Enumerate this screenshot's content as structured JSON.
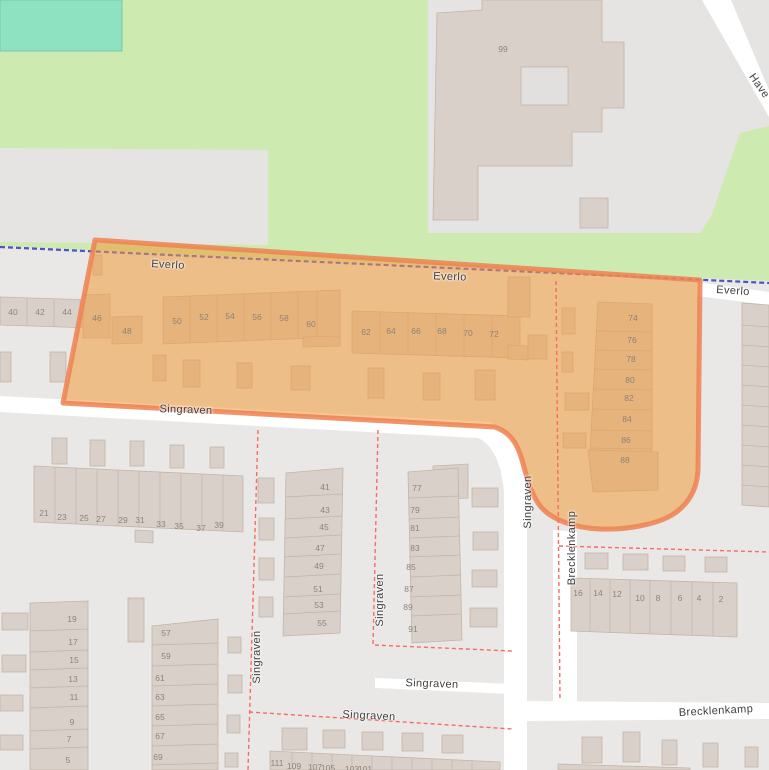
{
  "colors": {
    "grass": "#cdeab0",
    "pitch": "#8fe2c1",
    "residential": "#e9e8e6",
    "building": "#d9d0c9",
    "building_outline": "#c3b5a8",
    "road": "#ffffff",
    "highlight_fill": "#f29a3c",
    "highlight_stroke": "#ee8152",
    "admin_boundary_blue": "#4f51c6",
    "boundary_red": "#f96b60",
    "street_label": "#3f3f3f",
    "housenumber": "#8a8075"
  },
  "streets": [
    {
      "name": "Everlo",
      "x": 168,
      "y": 265,
      "rot": 3
    },
    {
      "name": "Everlo",
      "x": 450,
      "y": 277,
      "rot": 2
    },
    {
      "name": "Everlo",
      "x": 733,
      "y": 291,
      "rot": 4
    },
    {
      "name": "Have",
      "x": 759,
      "y": 86,
      "rot": 55
    },
    {
      "name": "Singraven",
      "x": 186,
      "y": 410,
      "rot": 2
    },
    {
      "name": "Singraven",
      "x": 528,
      "y": 502,
      "rot": -90
    },
    {
      "name": "Brecklenkamp",
      "x": 572,
      "y": 548,
      "rot": -90
    },
    {
      "name": "Singraven",
      "x": 257,
      "y": 657,
      "rot": -90
    },
    {
      "name": "Singraven",
      "x": 380,
      "y": 600,
      "rot": -90
    },
    {
      "name": "Singraven",
      "x": 432,
      "y": 684,
      "rot": 2
    },
    {
      "name": "Singraven",
      "x": 369,
      "y": 716,
      "rot": 3
    },
    {
      "name": "Brecklenkamp",
      "x": 716,
      "y": 711,
      "rot": -3
    }
  ],
  "house_numbers": [
    {
      "n": "40",
      "x": 13,
      "y": 312
    },
    {
      "n": "42",
      "x": 40,
      "y": 312
    },
    {
      "n": "44",
      "x": 67,
      "y": 312
    },
    {
      "n": "46",
      "x": 97,
      "y": 318
    },
    {
      "n": "48",
      "x": 127,
      "y": 331
    },
    {
      "n": "50",
      "x": 177,
      "y": 321
    },
    {
      "n": "52",
      "x": 204,
      "y": 317
    },
    {
      "n": "54",
      "x": 230,
      "y": 316
    },
    {
      "n": "56",
      "x": 257,
      "y": 317
    },
    {
      "n": "58",
      "x": 284,
      "y": 318
    },
    {
      "n": "60",
      "x": 311,
      "y": 324
    },
    {
      "n": "62",
      "x": 366,
      "y": 332
    },
    {
      "n": "64",
      "x": 391,
      "y": 331
    },
    {
      "n": "66",
      "x": 416,
      "y": 331
    },
    {
      "n": "68",
      "x": 442,
      "y": 331
    },
    {
      "n": "70",
      "x": 468,
      "y": 333
    },
    {
      "n": "72",
      "x": 494,
      "y": 334
    },
    {
      "n": "74",
      "x": 633,
      "y": 318
    },
    {
      "n": "76",
      "x": 632,
      "y": 340
    },
    {
      "n": "78",
      "x": 631,
      "y": 359
    },
    {
      "n": "80",
      "x": 630,
      "y": 380
    },
    {
      "n": "82",
      "x": 629,
      "y": 398
    },
    {
      "n": "84",
      "x": 627,
      "y": 419
    },
    {
      "n": "86",
      "x": 626,
      "y": 440
    },
    {
      "n": "88",
      "x": 625,
      "y": 460
    },
    {
      "n": "99",
      "x": 503,
      "y": 49
    },
    {
      "n": "21",
      "x": 44,
      "y": 513
    },
    {
      "n": "23",
      "x": 62,
      "y": 517
    },
    {
      "n": "25",
      "x": 84,
      "y": 518
    },
    {
      "n": "27",
      "x": 101,
      "y": 519
    },
    {
      "n": "29",
      "x": 123,
      "y": 520
    },
    {
      "n": "31",
      "x": 140,
      "y": 520
    },
    {
      "n": "33",
      "x": 161,
      "y": 524
    },
    {
      "n": "35",
      "x": 179,
      "y": 526
    },
    {
      "n": "37",
      "x": 201,
      "y": 528
    },
    {
      "n": "39",
      "x": 219,
      "y": 525
    },
    {
      "n": "19",
      "x": 72,
      "y": 619
    },
    {
      "n": "17",
      "x": 73,
      "y": 642
    },
    {
      "n": "15",
      "x": 74,
      "y": 660
    },
    {
      "n": "13",
      "x": 73,
      "y": 679
    },
    {
      "n": "11",
      "x": 74,
      "y": 697
    },
    {
      "n": "9",
      "x": 72,
      "y": 722
    },
    {
      "n": "7",
      "x": 69,
      "y": 739
    },
    {
      "n": "5",
      "x": 68,
      "y": 760
    },
    {
      "n": "57",
      "x": 166,
      "y": 633
    },
    {
      "n": "59",
      "x": 166,
      "y": 656
    },
    {
      "n": "61",
      "x": 160,
      "y": 678
    },
    {
      "n": "63",
      "x": 160,
      "y": 697
    },
    {
      "n": "65",
      "x": 160,
      "y": 717
    },
    {
      "n": "67",
      "x": 160,
      "y": 736
    },
    {
      "n": "69",
      "x": 158,
      "y": 757
    },
    {
      "n": "41",
      "x": 325,
      "y": 487
    },
    {
      "n": "43",
      "x": 325,
      "y": 510
    },
    {
      "n": "45",
      "x": 324,
      "y": 527
    },
    {
      "n": "47",
      "x": 320,
      "y": 548
    },
    {
      "n": "49",
      "x": 319,
      "y": 566
    },
    {
      "n": "51",
      "x": 318,
      "y": 589
    },
    {
      "n": "53",
      "x": 319,
      "y": 605
    },
    {
      "n": "55",
      "x": 322,
      "y": 623
    },
    {
      "n": "77",
      "x": 417,
      "y": 488
    },
    {
      "n": "79",
      "x": 415,
      "y": 510
    },
    {
      "n": "81",
      "x": 415,
      "y": 528
    },
    {
      "n": "83",
      "x": 415,
      "y": 548
    },
    {
      "n": "85",
      "x": 411,
      "y": 567
    },
    {
      "n": "87",
      "x": 409,
      "y": 589
    },
    {
      "n": "89",
      "x": 408,
      "y": 607
    },
    {
      "n": "91",
      "x": 413,
      "y": 629
    },
    {
      "n": "16",
      "x": 578,
      "y": 593
    },
    {
      "n": "14",
      "x": 598,
      "y": 593
    },
    {
      "n": "12",
      "x": 617,
      "y": 594
    },
    {
      "n": "10",
      "x": 640,
      "y": 598
    },
    {
      "n": "8",
      "x": 658,
      "y": 598
    },
    {
      "n": "6",
      "x": 680,
      "y": 598
    },
    {
      "n": "4",
      "x": 699,
      "y": 598
    },
    {
      "n": "2",
      "x": 721,
      "y": 599
    },
    {
      "n": "111",
      "x": 277,
      "y": 763
    },
    {
      "n": "109",
      "x": 294,
      "y": 766
    },
    {
      "n": "107",
      "x": 315,
      "y": 767
    },
    {
      "n": "105",
      "x": 328,
      "y": 768
    },
    {
      "n": "103",
      "x": 352,
      "y": 769
    },
    {
      "n": "101",
      "x": 365,
      "y": 769
    }
  ]
}
